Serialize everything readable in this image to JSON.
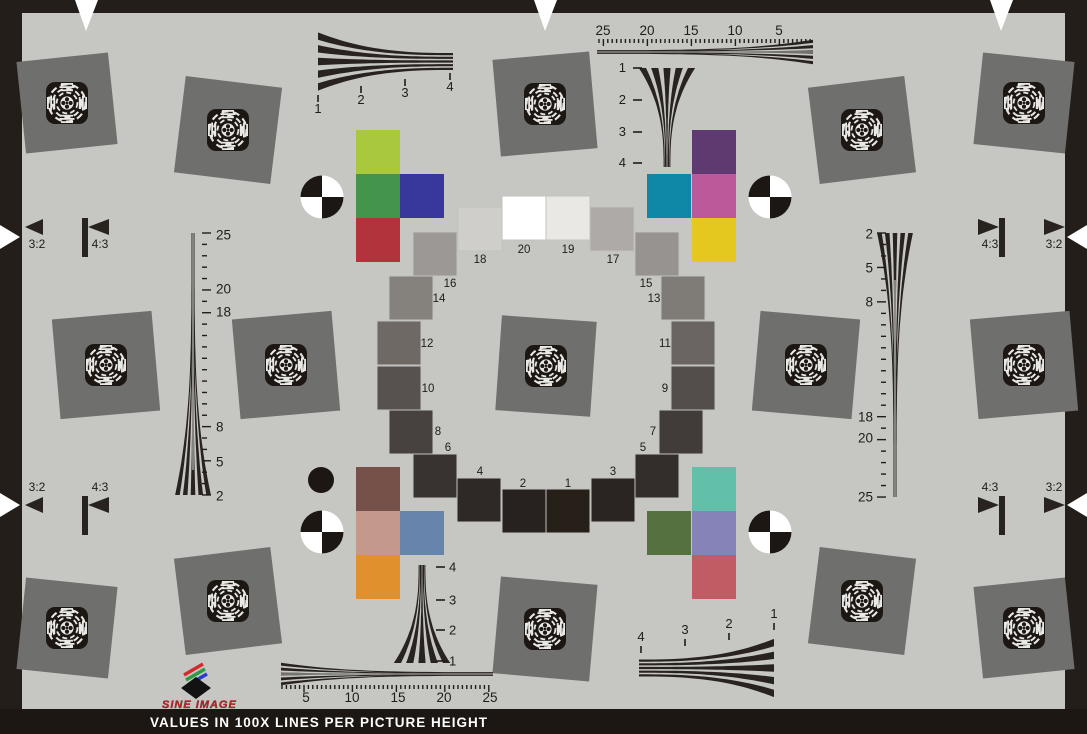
{
  "colors": {
    "background": "#c6c7c3",
    "frame": "#241e1a",
    "square_gray": "#6f6f6d",
    "ink": "#292320",
    "ruler_gray": "#8d8d8a",
    "white": "#ffffff",
    "brand_red": "#c4242b"
  },
  "footer": {
    "note": "VALUES IN 100X LINES PER PICTURE HEIGHT"
  },
  "logo": {
    "brand": "SINE IMAGE"
  },
  "aspect_markers": {
    "top_left": [
      "3:2",
      "4:3"
    ],
    "top_right": [
      "4:3",
      "3:2"
    ],
    "bottom_left": [
      "3:2",
      "4:3"
    ],
    "bottom_right": [
      "4:3",
      "3:2"
    ]
  },
  "scales": {
    "top_left_wedge": [
      "1",
      "2",
      "3",
      "4"
    ],
    "top_right_ruler": [
      "25",
      "20",
      "15",
      "10",
      "5"
    ],
    "top_right_wedge": [
      "1",
      "2",
      "3",
      "4"
    ],
    "left_ruler": [
      "25",
      "20",
      "18",
      "8",
      "5",
      "2"
    ],
    "right_ruler": [
      "2",
      "5",
      "8",
      "18",
      "20",
      "25"
    ],
    "bottom_center_wedge": [
      "4",
      "3",
      "2",
      "1"
    ],
    "bottom_left_ruler": [
      "5",
      "10",
      "15",
      "20",
      "25"
    ],
    "bottom_right_wedge": [
      "4",
      "3",
      "2",
      "1"
    ]
  },
  "grayscale_ring": {
    "chips": [
      {
        "n": "1",
        "color": "#262019"
      },
      {
        "n": "2",
        "color": "#27211f"
      },
      {
        "n": "3",
        "color": "#2a2422"
      },
      {
        "n": "4",
        "color": "#2e2826"
      },
      {
        "n": "5",
        "color": "#332d2b"
      },
      {
        "n": "6",
        "color": "#383231"
      },
      {
        "n": "7",
        "color": "#413b39"
      },
      {
        "n": "8",
        "color": "#474140"
      },
      {
        "n": "9",
        "color": "#534e4b"
      },
      {
        "n": "10",
        "color": "#575250"
      },
      {
        "n": "11",
        "color": "#6a6562"
      },
      {
        "n": "12",
        "color": "#6e6965"
      },
      {
        "n": "13",
        "color": "#7f7b77"
      },
      {
        "n": "14",
        "color": "#85817d"
      },
      {
        "n": "15",
        "color": "#969390"
      },
      {
        "n": "16",
        "color": "#9b9895"
      },
      {
        "n": "17",
        "color": "#adaaa7"
      },
      {
        "n": "18",
        "color": "#cfcecb"
      },
      {
        "n": "19",
        "color": "#e9e8e5"
      },
      {
        "n": "20",
        "color": "#ffffff"
      }
    ]
  },
  "color_patches": {
    "top_left": [
      {
        "name": "yellow-green",
        "color": "#a9c83d"
      },
      {
        "name": "green",
        "color": "#44954b"
      },
      {
        "name": "blue",
        "color": "#37379c"
      },
      {
        "name": "red",
        "color": "#b2333b"
      }
    ],
    "top_right": [
      {
        "name": "purple",
        "color": "#5f3a71"
      },
      {
        "name": "teal",
        "color": "#0e88a6"
      },
      {
        "name": "magenta",
        "color": "#bc599b"
      },
      {
        "name": "yellow",
        "color": "#e5c81f"
      }
    ],
    "bottom_left": [
      {
        "name": "brown",
        "color": "#75514a"
      },
      {
        "name": "salmon",
        "color": "#c4988a"
      },
      {
        "name": "steel-blue",
        "color": "#6784ad"
      },
      {
        "name": "orange",
        "color": "#e0902d"
      }
    ],
    "bottom_right": [
      {
        "name": "mint",
        "color": "#62c0a9"
      },
      {
        "name": "olive-green",
        "color": "#567140"
      },
      {
        "name": "violet",
        "color": "#8583b7"
      },
      {
        "name": "rose",
        "color": "#c25c64"
      }
    ]
  }
}
